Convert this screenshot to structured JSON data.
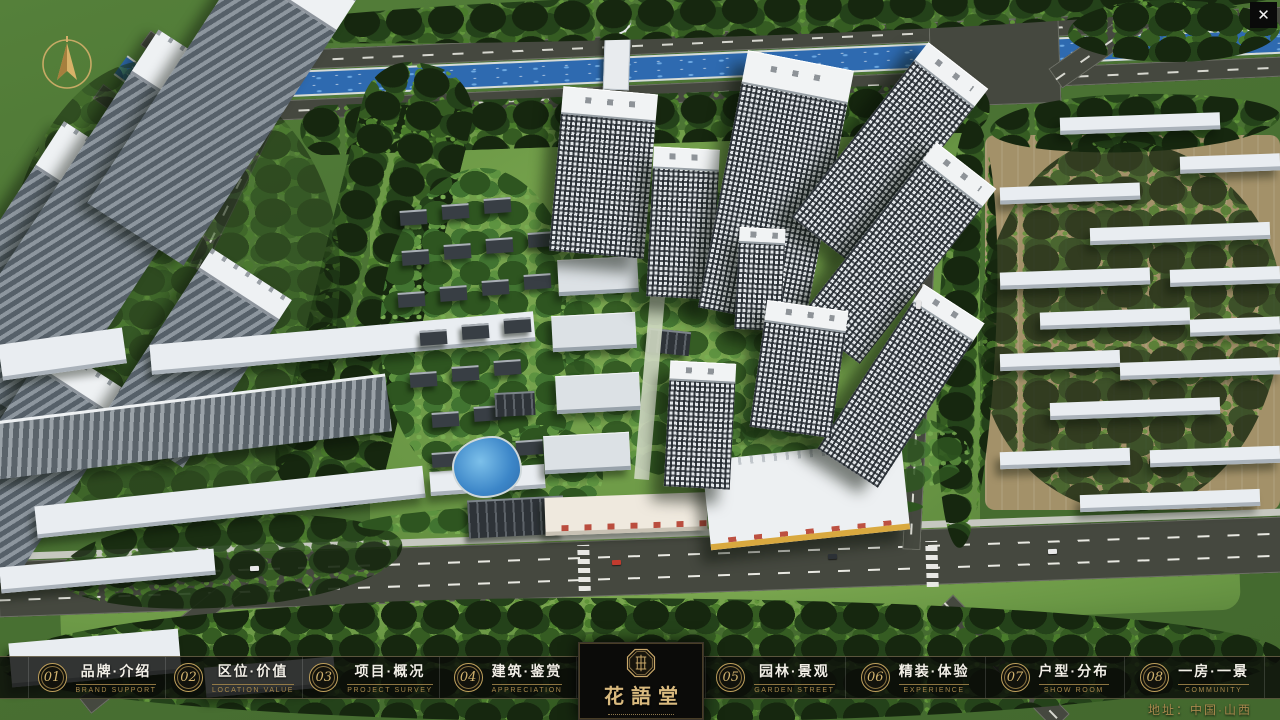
{
  "app": {
    "close_label": "✕"
  },
  "nav": {
    "items": [
      {
        "num": "01",
        "zh": "品牌·介绍",
        "en": "BRAND SUPPORT"
      },
      {
        "num": "02",
        "zh": "区位·价值",
        "en": "LOCATION VALUE"
      },
      {
        "num": "03",
        "zh": "项目·概况",
        "en": "PROJECT SURVEY"
      },
      {
        "num": "04",
        "zh": "建筑·鉴赏",
        "en": "APPRECIATION"
      },
      {
        "num": "05",
        "zh": "园林·景观",
        "en": "GARDEN STREET"
      },
      {
        "num": "06",
        "zh": "精装·体验",
        "en": "EXPERIENCE"
      },
      {
        "num": "07",
        "zh": "户型·分布",
        "en": "SHOW ROOM"
      },
      {
        "num": "08",
        "zh": "一房·一景",
        "en": "COMMUNITY"
      }
    ]
  },
  "logo": {
    "title": "花語堂"
  },
  "footer": {
    "address": "地址：中国·山西"
  },
  "colors": {
    "gold": "#c9a86a",
    "bar_bg": "rgba(10,11,9,0.82)",
    "river_blue": "#2e6ab0"
  }
}
